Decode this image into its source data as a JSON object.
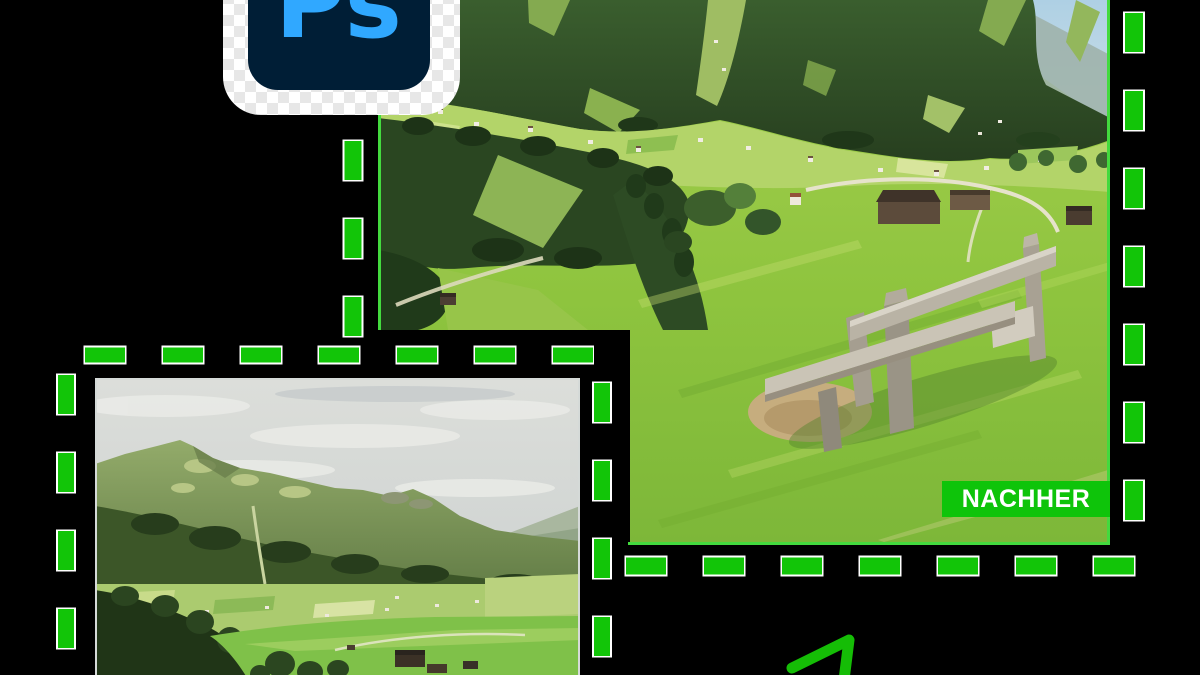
{
  "canvas": {
    "width": 1200,
    "height": 675,
    "background": "#000000"
  },
  "photoshop_icon": {
    "text": "Ps",
    "card_color": "#ffffff",
    "checker_color": "#e7e7e7",
    "logo_background": "#001e36",
    "logo_text_color": "#30a8ff"
  },
  "after_photo": {
    "badge_label": "NACHHER",
    "badge_background": "#0ec40a",
    "badge_text_color": "#ffffff",
    "description": "alpine-valley-meadow-with-wooden-bench"
  },
  "before_photo": {
    "description": "alpine-mountain-panorama",
    "border_color": "#d5dad8"
  },
  "selection_marquee": {
    "dash_color": "#12c508",
    "dash_halo_color": "#ffffff",
    "edge_line_color": "#43da3e"
  },
  "arrow": {
    "color": "#15bd06"
  }
}
